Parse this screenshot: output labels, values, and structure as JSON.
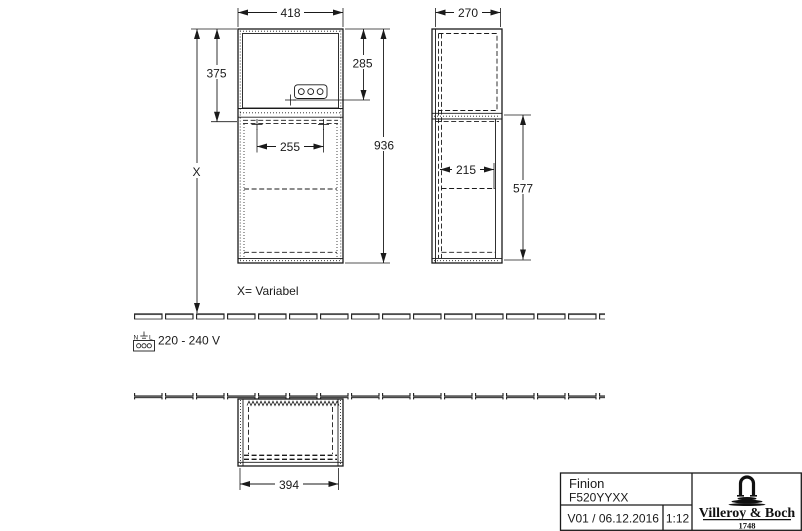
{
  "colors": {
    "line": "#1a1a1a",
    "background": "#ffffff"
  },
  "drawing": {
    "dimensions": {
      "front_width": "418",
      "side_depth": "270",
      "upper_section_height": "375",
      "socket_height": "285",
      "total_height": "936",
      "shelf_inner_width": "255",
      "side_inner_depth": "215",
      "lower_section_height": "577",
      "plan_width": "394"
    },
    "labels": {
      "variable_symbol": "X",
      "variable_note": "X= Variabel",
      "voltage": "220 - 240 V",
      "socket_neutral": "N",
      "socket_line": "L"
    },
    "icons": {
      "socket": "power-socket-icon",
      "ground": "earth-ground-icon",
      "brand_mark": "fountain-icon"
    }
  },
  "title_block": {
    "product_name": "Finion",
    "article_number": "F520YYXX",
    "version_date": "V01 / 06.12.2016",
    "scale": "1:12",
    "brand_name": "Villeroy & Boch",
    "brand_year": "1748"
  }
}
